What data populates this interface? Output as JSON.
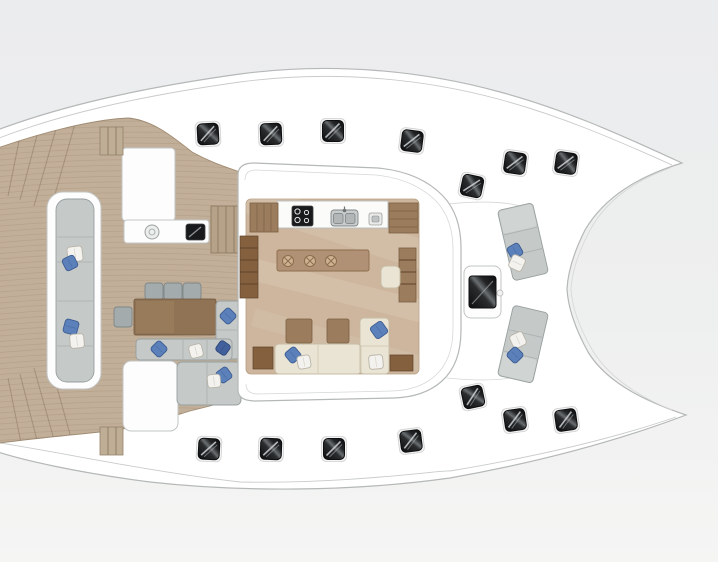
{
  "meta": {
    "description": "Top-view deck floor plan of a sailing catamaran: twin bows pointing right, aft teak cockpit to the left, central salon with galley, island bar and lounge seating, foredeck seats between the bows.",
    "visible_text": []
  },
  "palette": {
    "background": "#eef0ef",
    "hull_white": "#ffffff",
    "outline_gray": "#b5b8b8",
    "teak_deck": "#c2af99",
    "plank_line": "#9b8469",
    "salon_floor": "#cdb69d",
    "table_wood": "#8f7354",
    "cabinet_wood": "#9b7d5e",
    "island_wood": "#b09175",
    "cushion_gray": "#c5c9c8",
    "sofa_cream": "#eae4d4",
    "pillow_blue": "#5b80ba",
    "pillow_navy": "#42619c",
    "pillow_white": "#f4f2ee",
    "hatch_black": "#191a1c"
  },
  "deck_hatches": {
    "size": 21,
    "items": [
      {
        "cx": 208,
        "cy": 134,
        "rot": -3
      },
      {
        "cx": 271,
        "cy": 134,
        "rot": -2
      },
      {
        "cx": 333,
        "cy": 131,
        "rot": 0
      },
      {
        "cx": 412,
        "cy": 141,
        "rot": 7
      },
      {
        "cx": 472,
        "cy": 186,
        "rot": 12
      },
      {
        "cx": 515,
        "cy": 163,
        "rot": 8
      },
      {
        "cx": 566,
        "cy": 163,
        "rot": 8
      },
      {
        "cx": 209,
        "cy": 449,
        "rot": 3
      },
      {
        "cx": 271,
        "cy": 449,
        "rot": 2
      },
      {
        "cx": 334,
        "cy": 449,
        "rot": 0
      },
      {
        "cx": 411,
        "cy": 441,
        "rot": -7
      },
      {
        "cx": 473,
        "cy": 397,
        "rot": -12
      },
      {
        "cx": 515,
        "cy": 420,
        "rot": -8
      },
      {
        "cx": 566,
        "cy": 420,
        "rot": -8
      }
    ]
  },
  "bar_stools": {
    "radius": 5.5,
    "items": [
      {
        "cx": 288,
        "cy": 261
      },
      {
        "cx": 310,
        "cy": 261
      },
      {
        "cx": 331,
        "cy": 261
      }
    ]
  },
  "pillows": [
    {
      "cx": 75,
      "cy": 254,
      "s": 15,
      "rot": 38,
      "c": "w"
    },
    {
      "cx": 70,
      "cy": 263,
      "s": 13,
      "rot": 18,
      "c": "b"
    },
    {
      "cx": 71,
      "cy": 327,
      "s": 14,
      "rot": -30,
      "c": "b"
    },
    {
      "cx": 77,
      "cy": 341,
      "s": 14,
      "rot": 40,
      "c": "w"
    },
    {
      "cx": 228,
      "cy": 316,
      "s": 13,
      "rot": 0,
      "c": "b"
    },
    {
      "cx": 159,
      "cy": 349,
      "s": 13,
      "rot": 0,
      "c": "b"
    },
    {
      "cx": 196,
      "cy": 351,
      "s": 13,
      "rot": 30,
      "c": "w"
    },
    {
      "cx": 223,
      "cy": 348,
      "s": 12,
      "rot": 80,
      "c": "n"
    },
    {
      "cx": 224,
      "cy": 375,
      "s": 13,
      "rot": 10,
      "c": "b"
    },
    {
      "cx": 214,
      "cy": 381,
      "s": 13,
      "rot": 40,
      "c": "w"
    },
    {
      "cx": 293,
      "cy": 355,
      "s": 13,
      "rot": 5,
      "c": "b"
    },
    {
      "cx": 304,
      "cy": 362,
      "s": 13,
      "rot": 35,
      "c": "w"
    },
    {
      "cx": 379,
      "cy": 330,
      "s": 14,
      "rot": 10,
      "c": "b"
    },
    {
      "cx": 376,
      "cy": 362,
      "s": 14,
      "rot": 40,
      "c": "w"
    },
    {
      "cx": 515,
      "cy": 251,
      "s": 13,
      "rot": 15,
      "c": "b"
    },
    {
      "cx": 517,
      "cy": 263,
      "s": 14,
      "rot": -20,
      "c": "w"
    },
    {
      "cx": 518,
      "cy": 340,
      "s": 14,
      "rot": 20,
      "c": "w"
    },
    {
      "cx": 515,
      "cy": 355,
      "s": 13,
      "rot": 0,
      "c": "b"
    }
  ],
  "teak_planks": {
    "y_start": 122,
    "y_end": 452,
    "spacing": 5.5
  },
  "transom_step_lines": [
    [
      22,
      126,
      8,
      196
    ],
    [
      40,
      124,
      20,
      200
    ],
    [
      58,
      122,
      34,
      206
    ],
    [
      76,
      120,
      50,
      212
    ],
    [
      22,
      448,
      8,
      378
    ],
    [
      40,
      452,
      20,
      374
    ],
    [
      58,
      454,
      34,
      368
    ],
    [
      76,
      456,
      50,
      362
    ]
  ],
  "counts": {
    "deck_hatches": 14,
    "bar_stools": 3,
    "pillows": 18,
    "dining_chairs": 4,
    "foredeck_seats": 2
  }
}
